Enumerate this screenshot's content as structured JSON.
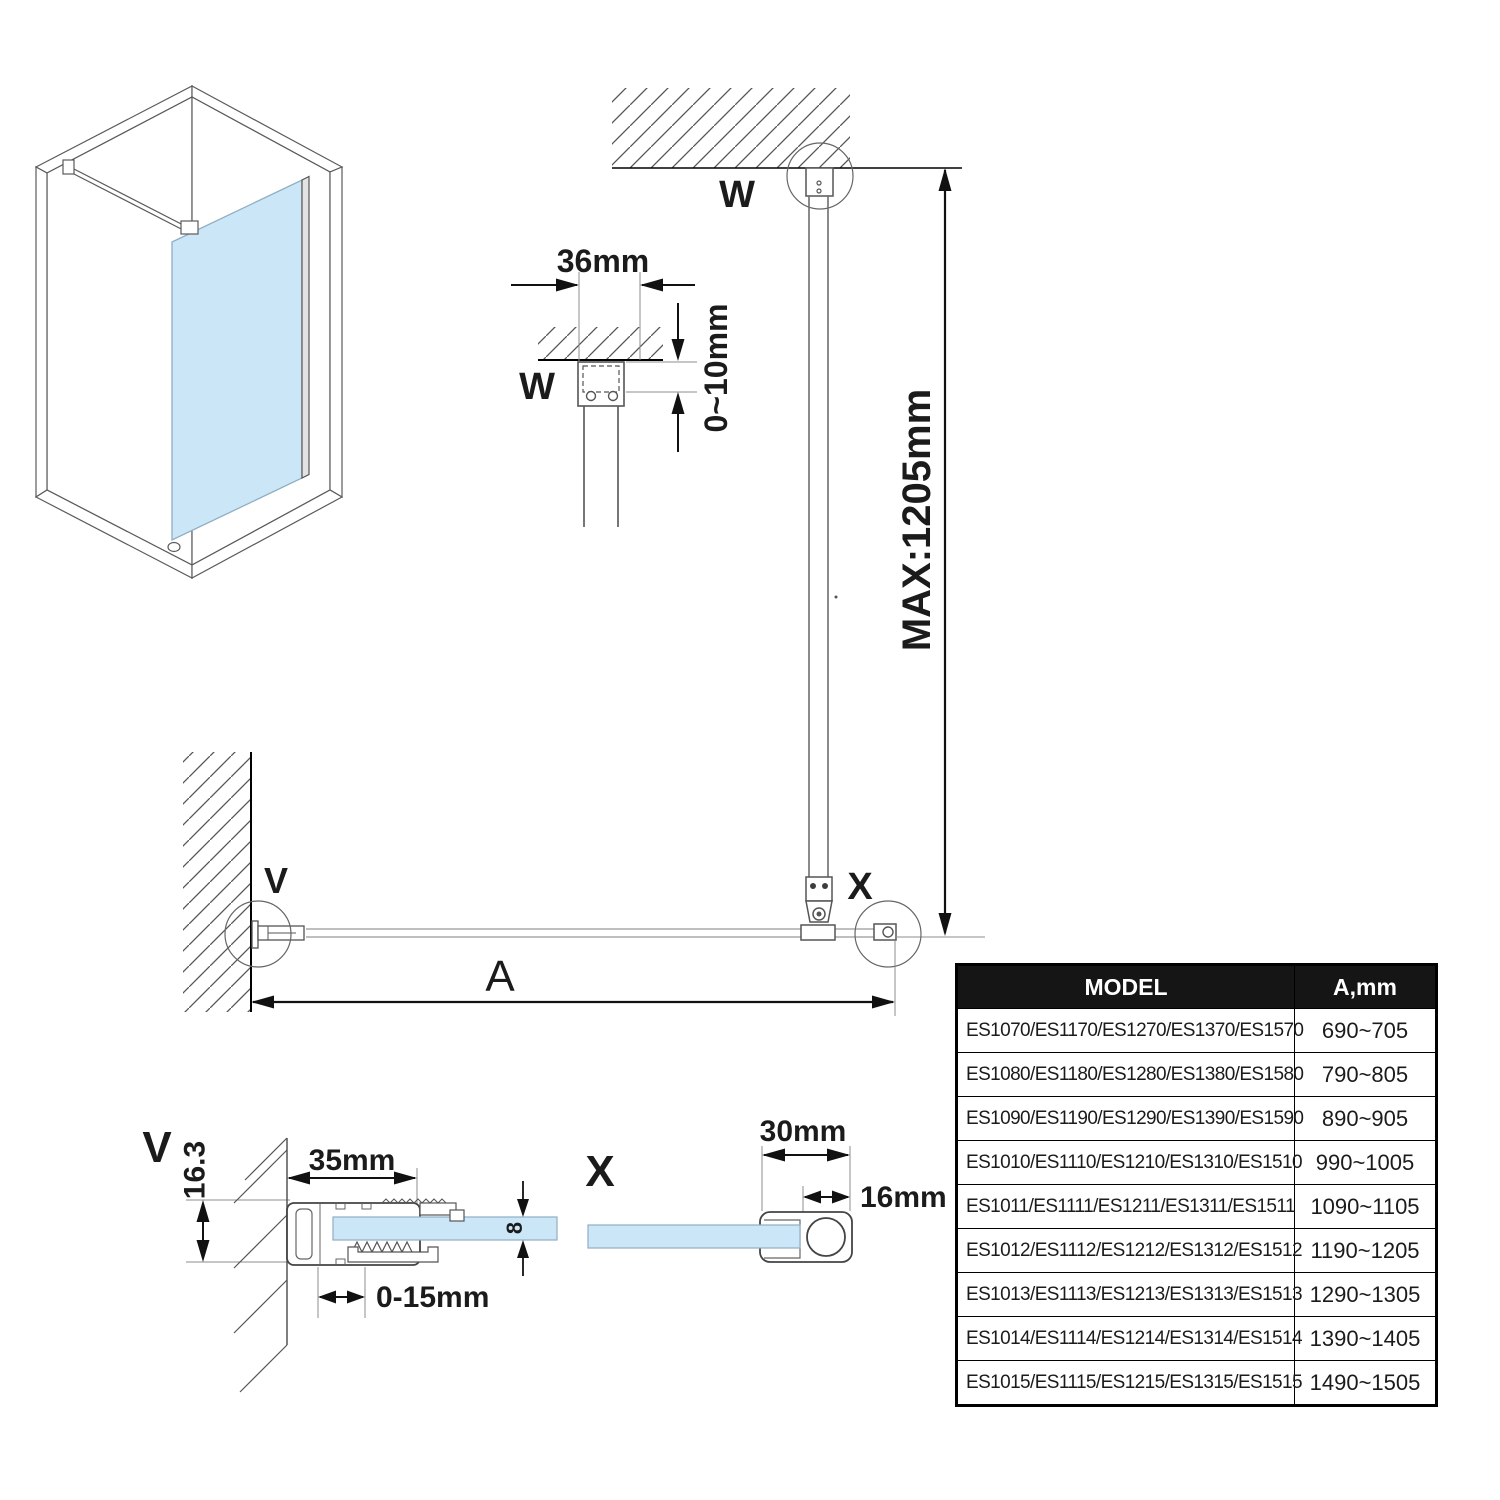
{
  "labels": {
    "w_section": "W",
    "w_plan": "W",
    "v_plan": "V",
    "v_section": "V",
    "x_plan": "X",
    "x_section": "X"
  },
  "dims": {
    "bracket_width": "36mm",
    "ceiling_gap": "0~10mm",
    "max_height": "MAX:1205mm",
    "width_label": "A",
    "profile_width": "35mm",
    "profile_offset": "16.3",
    "glass_thickness": "8",
    "adjust_range": "0-15mm",
    "end_profile_width": "30mm",
    "end_profile_depth": "16mm"
  },
  "colors": {
    "glass": "#cbe7f7",
    "glass_edge": "#90aec4",
    "line": "#555555",
    "dim_line": "#111111"
  },
  "table": {
    "headers": [
      "MODEL",
      "A,mm"
    ],
    "rows": [
      {
        "model": "ES1070/ES1170/ES1270/ES1370/ES1570",
        "a": "690~705"
      },
      {
        "model": "ES1080/ES1180/ES1280/ES1380/ES1580",
        "a": "790~805"
      },
      {
        "model": "ES1090/ES1190/ES1290/ES1390/ES1590",
        "a": "890~905"
      },
      {
        "model": "ES1010/ES1110/ES1210/ES1310/ES1510",
        "a": "990~1005"
      },
      {
        "model": "ES1011/ES1111/ES1211/ES1311/ES1511",
        "a": "1090~1105"
      },
      {
        "model": "ES1012/ES1112/ES1212/ES1312/ES1512",
        "a": "1190~1205"
      },
      {
        "model": "ES1013/ES1113/ES1213/ES1313/ES1513",
        "a": "1290~1305"
      },
      {
        "model": "ES1014/ES1114/ES1214/ES1314/ES1514",
        "a": "1390~1405"
      },
      {
        "model": "ES1015/ES1115/ES1215/ES1315/ES1515",
        "a": "1490~1505"
      }
    ]
  }
}
